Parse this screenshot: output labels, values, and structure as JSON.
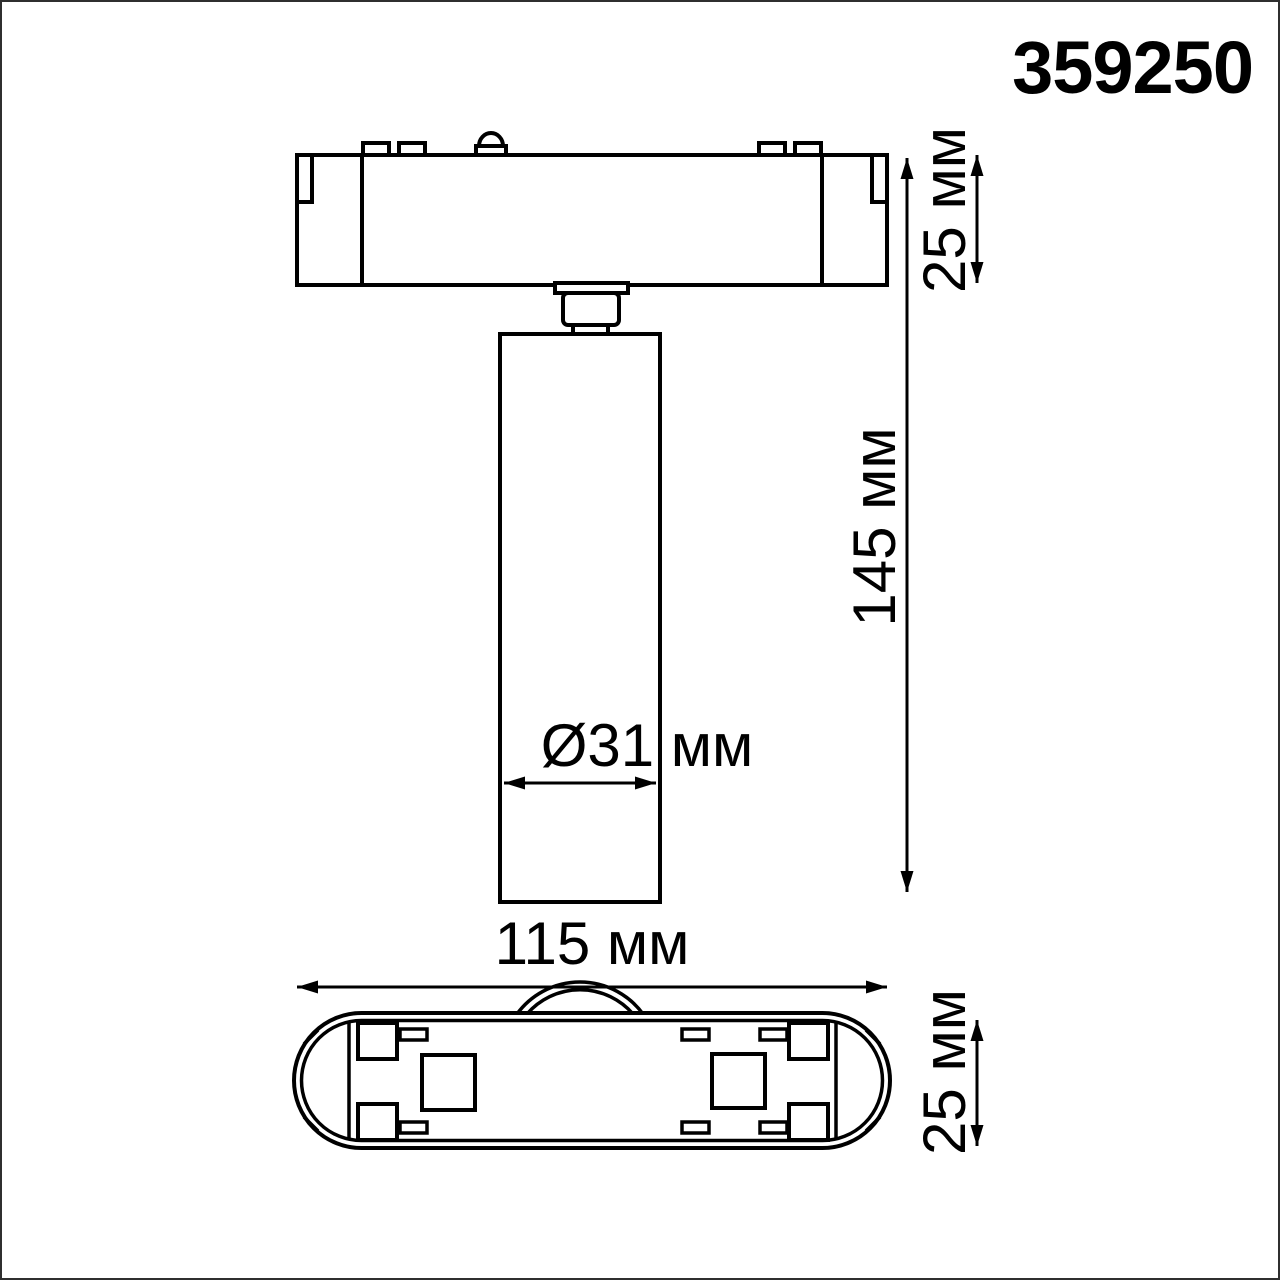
{
  "product_code": "359250",
  "drawing": {
    "type": "technical-dimension-drawing",
    "views": [
      "front-view",
      "bottom-view"
    ],
    "labels": {
      "adapter_height": "25 мм",
      "total_height": "145 мм",
      "diameter": "Ø31 мм",
      "length": "115 мм",
      "base_height": "25 мм"
    },
    "dimensions_mm": {
      "adapter_height": 25,
      "total_height": 145,
      "spot_diameter": 31,
      "length": 115,
      "base_height": 25
    }
  },
  "colors": {
    "line": "#000000",
    "background": "#ffffff",
    "page_border": "#2f2f2f"
  }
}
